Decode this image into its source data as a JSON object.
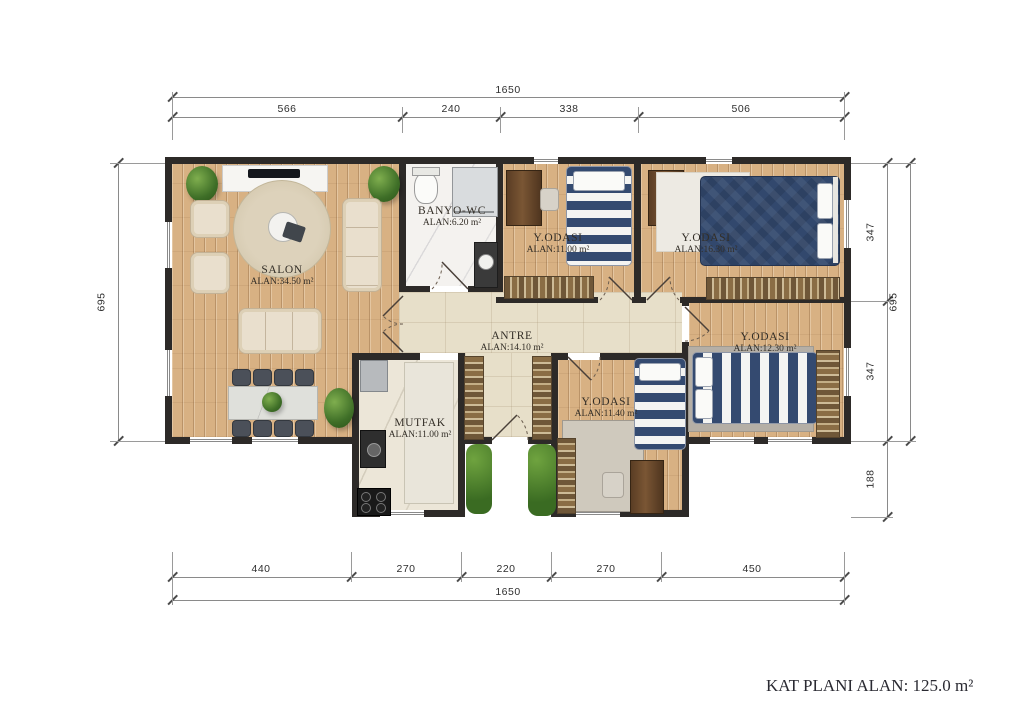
{
  "title": "KAT PLANI ALAN: 125.0 m²",
  "rooms": [
    {
      "id": "salon",
      "name": "SALON",
      "area": "ALAN:34.50 m²"
    },
    {
      "id": "banyo",
      "name": "BANYO-WC",
      "area": "ALAN:6.20 m²"
    },
    {
      "id": "yodasi1",
      "name": "Y.ODASI",
      "area": "ALAN:11.00 m²"
    },
    {
      "id": "yodasi2",
      "name": "Y.ODASI",
      "area": "ALAN:16.30 m²"
    },
    {
      "id": "yodasi3",
      "name": "Y.ODASI",
      "area": "ALAN:12.30 m²"
    },
    {
      "id": "antre",
      "name": "ANTRE",
      "area": "ALAN:14.10 m²"
    },
    {
      "id": "mutfak",
      "name": "MUTFAK",
      "area": "ALAN:11.00 m²"
    },
    {
      "id": "yodasi4",
      "name": "Y.ODASI",
      "area": "ALAN:11.40 m²"
    }
  ],
  "dimensions": {
    "top_total": "1650",
    "top_segments": [
      "566",
      "240",
      "338",
      "506"
    ],
    "bottom_segments": [
      "440",
      "270",
      "220",
      "270",
      "450"
    ],
    "bottom_total": "1650",
    "left_total": "695",
    "right_segments": [
      "347",
      "347",
      "188"
    ],
    "right_total": "695"
  },
  "colors": {
    "wall": "#2d2a28",
    "wood_floor": "#d8b183",
    "stone_floor": "#e7dfc9",
    "bath_floor": "#f4f2ef",
    "navy_bedding": "#32486d",
    "rug_brown": "#6f5738",
    "plant_green": "#3e6e27"
  }
}
